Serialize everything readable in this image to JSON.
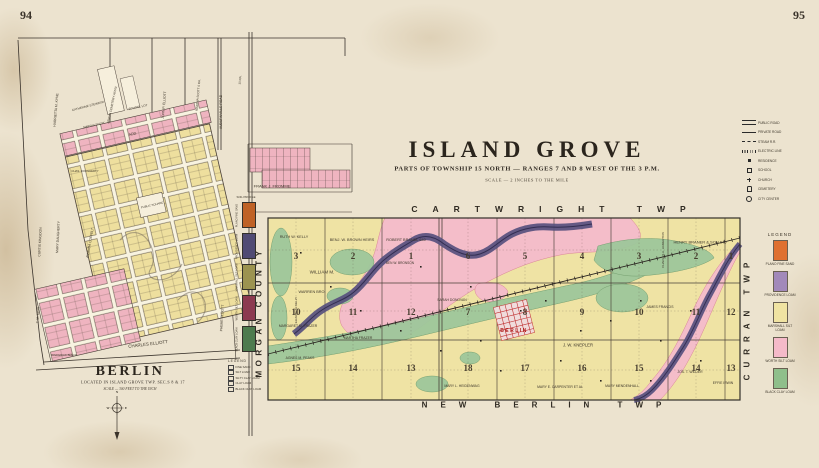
{
  "page": {
    "left_number": "94",
    "right_number": "95"
  },
  "island_grove": {
    "title": "ISLAND GROVE",
    "subtitle": "PARTS OF TOWNSHIP 15 NORTH — RANGES 7 AND 8 WEST OF THE 3 P.M.",
    "scale_note": "SCALE — 2 INCHES TO THE MILE",
    "edge_labels": {
      "top": "CARTWRIGHT TWP",
      "bottom": "NEW BERLIN TWP",
      "left": "MORGAN COUNTY",
      "right": "CURRAN TWP"
    },
    "town_label": "BERLIN",
    "sections_west": [
      [
        "3",
        "2",
        "1"
      ],
      [
        "10",
        "11",
        "12"
      ],
      [
        "15",
        "14",
        "13"
      ]
    ],
    "sections_east": [
      [
        "6",
        "5",
        "4",
        "3",
        "2",
        "1"
      ],
      [
        "7",
        "8",
        "9",
        "10",
        "11",
        "12"
      ],
      [
        "18",
        "17",
        "16",
        "15",
        "14",
        "13"
      ]
    ],
    "parcels": [
      {
        "label": "RUTH W. KELLY",
        "x": 294,
        "y": 237
      },
      {
        "label": "BENJ. W. BROWN HEIRS",
        "x": 352,
        "y": 240
      },
      {
        "label": "ROBERT BRANDL 640",
        "x": 406,
        "y": 240
      },
      {
        "label": "BEN W. BRONSON",
        "x": 400,
        "y": 263,
        "size": 3.2
      },
      {
        "label": "WILLIAM M.",
        "x": 322,
        "y": 272,
        "size": 4.5
      },
      {
        "label": "WARREN BRO.",
        "x": 312,
        "y": 292
      },
      {
        "label": "ELIZABETH KELLY",
        "x": 296,
        "y": 310,
        "rot": -90,
        "size": 3
      },
      {
        "label": "MARGARET M. FRAZER",
        "x": 298,
        "y": 326,
        "size": 3.4
      },
      {
        "label": "MARTHA FRAZER",
        "x": 358,
        "y": 338,
        "size": 3.4
      },
      {
        "label": "AGNES M. PEAKS",
        "x": 300,
        "y": 358,
        "size": 3.4
      },
      {
        "label": "SARAH DONOVAN",
        "x": 452,
        "y": 300,
        "size": 3.4
      },
      {
        "label": "J. W. KNEPLER",
        "x": 578,
        "y": 345,
        "size": 4.2
      },
      {
        "label": "MARY E. CARPENTER ET AL",
        "x": 560,
        "y": 387,
        "size": 3.4
      },
      {
        "label": "MARY L. HEIDENWAG",
        "x": 462,
        "y": 386,
        "size": 3.4
      },
      {
        "label": "MARY MENDENHALL",
        "x": 622,
        "y": 386,
        "size": 3.4
      },
      {
        "label": "HENRY BRANER & SON 640",
        "x": 700,
        "y": 242,
        "size": 4
      },
      {
        "label": "CHARLES A. HAMERTON",
        "x": 663,
        "y": 250,
        "rot": -90,
        "size": 3
      },
      {
        "label": "JAMES FRANCIS",
        "x": 660,
        "y": 307,
        "size": 3.4
      },
      {
        "label": "JOS. T. WILDER",
        "x": 690,
        "y": 372,
        "size": 3.4
      },
      {
        "label": "EFFIE IRWIN",
        "x": 723,
        "y": 383,
        "size": 3.4
      }
    ],
    "legend": {
      "title": "LEGEND",
      "items": [
        {
          "label": "PLANO FINE SAND",
          "color": "#df7030"
        },
        {
          "label": "PROVIDENCE LOAM",
          "color": "#a289ba"
        },
        {
          "label": "MARSHALL SILT LOAM",
          "color": "#f0e3a2"
        },
        {
          "label": "WORTH SILT LOAM",
          "color": "#f5bac9"
        },
        {
          "label": "BLACK CLAY LOAM",
          "color": "#8fbf8b"
        }
      ]
    },
    "key": {
      "items": [
        "PUBLIC ROAD",
        "PRIVATE ROAD",
        "STEAM R.R.",
        "ELECTRIC LINE",
        "RESIDENCE",
        "SCHOOL",
        "CHURCH",
        "CEMETERY",
        "CITY CENTER"
      ]
    }
  },
  "berlin_plat": {
    "title": "BERLIN",
    "subtitle": "LOCATED IN ISLAND GROVE TWP. SEC.S 8 & 17",
    "scale_note": "SCALE — 300 FEET TO THE INCH",
    "compass": {
      "n": "N",
      "w": "W",
      "e": "E"
    },
    "labels": [
      {
        "label": "HARRIETTA M. KYNE",
        "x": 56,
        "y": 110,
        "rot": -85
      },
      {
        "label": "CATHERINE STEWARD",
        "x": 88,
        "y": 106,
        "rot": -15,
        "size": 3
      },
      {
        "label": "BERLIN CEMETERY ASS'N",
        "x": 112,
        "y": 105,
        "rot": -78,
        "size": 3
      },
      {
        "label": "SCHOOL LOT",
        "x": 138,
        "y": 107,
        "rot": -12,
        "size": 3
      },
      {
        "label": "JOHN P. ELLIOTT",
        "x": 164,
        "y": 105,
        "rot": -85
      },
      {
        "label": "MARTHA SCOTT 6 RA.",
        "x": 198,
        "y": 95,
        "rot": -85,
        "size": 3
      },
      {
        "label": "10 RA.",
        "x": 240,
        "y": 80,
        "rot": -85,
        "size": 3
      },
      {
        "label": "AUBURNVILLE ROAD",
        "x": 221,
        "y": 112,
        "rot": -90,
        "size": 3.4
      },
      {
        "label": "MARTHA SCOTT",
        "x": 94,
        "y": 125,
        "rot": -12,
        "size": 2.8
      },
      {
        "label": "ADD.",
        "x": 133,
        "y": 134,
        "rot": -12,
        "size": 3.6
      },
      {
        "label": "CHAS. DOUGHERTY",
        "x": 85,
        "y": 171,
        "size": 2.8
      },
      {
        "label": "CURTIS KINGDON",
        "x": 40,
        "y": 242,
        "rot": -87
      },
      {
        "label": "MARY DAUGHERTY",
        "x": 58,
        "y": 237,
        "rot": -87
      },
      {
        "label": "AMANDA COFFELT",
        "x": 90,
        "y": 243,
        "rot": -80
      },
      {
        "label": "PUBLIC SQUARE",
        "x": 152,
        "y": 205,
        "rot": -13,
        "size": 2.8
      },
      {
        "label": "FRANK J. FROMME",
        "x": 272,
        "y": 186,
        "size": 4
      },
      {
        "label": "CHARLES ELLIOTT",
        "x": 148,
        "y": 344,
        "rot": -7,
        "size": 4.4
      },
      {
        "label": "PHEME ELLIOTT",
        "x": 222,
        "y": 318,
        "rot": -87
      },
      {
        "label": "T. M. KING",
        "x": 38,
        "y": 315,
        "rot": -87
      },
      {
        "label": "FREDERICK BRECK",
        "x": 64,
        "y": 355,
        "size": 2.8
      }
    ]
  },
  "soil_strip": {
    "caption": "SOIL PROFILE",
    "items": [
      {
        "label": "PLANO FINE SAND",
        "color": "#bf6226"
      },
      {
        "label": "PROVIDENCE LOAM",
        "color": "#514b74"
      },
      {
        "label": "MARSHALL SILT LOAM",
        "color": "#9c9350"
      },
      {
        "label": "WORTH SILT LOAM",
        "color": "#8c3a50"
      },
      {
        "label": "BLACK CLAY LOAM",
        "color": "#4e7b4e"
      }
    ],
    "legend_title": "LEGEND",
    "legend_items": [
      "FINE SAND",
      "SILT LOAM",
      "SILTY CLAY LOAM",
      "CLAY LOAM",
      "BLACK CLAY LOAM"
    ]
  }
}
